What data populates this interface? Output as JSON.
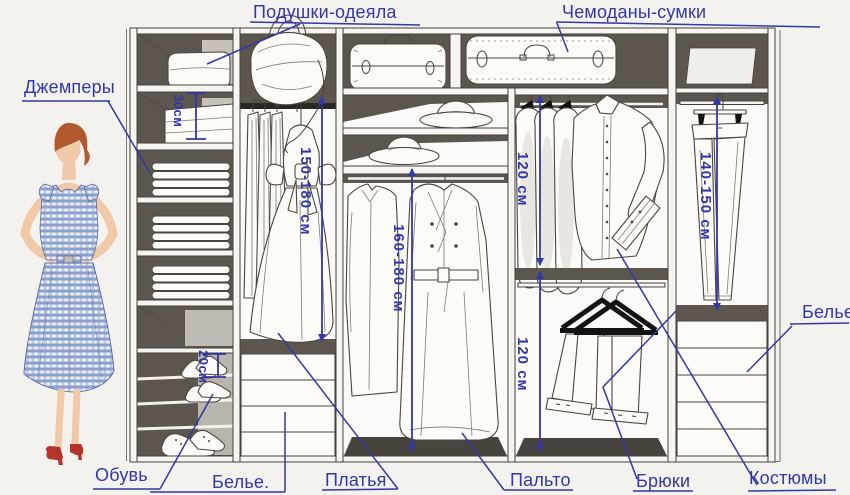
{
  "annotations": {
    "pillows_blankets": "Подушки-одеяла",
    "suitcases_bags": "Чемоданы-сумки",
    "jumpers": "Джемперы",
    "shoes": "Обувь",
    "linen_bottom": "Белье.",
    "dresses": "Платья",
    "coats": "Пальто",
    "trousers": "Брюки",
    "suits": "Костюмы",
    "linen_right": "Белье"
  },
  "measurements": {
    "top_shelf_height": "30см",
    "shoe_shelf_height": "20см",
    "dress_section_height": "150-180 см",
    "coat_section_height": "160-180 см",
    "shirt_section_height": "120 см",
    "lower_rod_section_height": "120 см",
    "trouser_section_height": "140-150 см"
  },
  "colors": {
    "annotation_blue": "#3238a6",
    "cabinet_dark": "#5c564e",
    "outline_dark": "#4a453e",
    "background": "#f3f2ef",
    "shoe_red": "#b5342a",
    "hair_auburn": "#b0582e",
    "dress_check_blue": "#8ba0d0"
  }
}
